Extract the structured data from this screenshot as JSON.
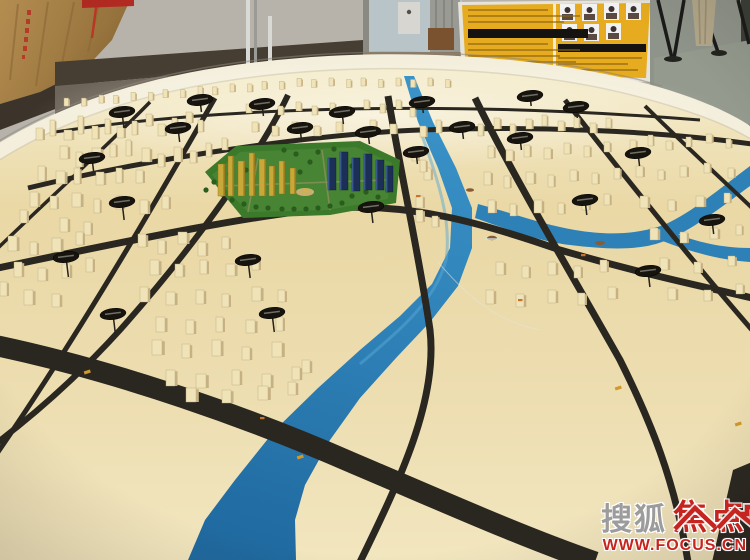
{
  "watermark": {
    "brand_gray": "搜狐",
    "brand_red": "焦点",
    "url": "WWW.FOCUS.CN"
  },
  "colors": {
    "wall": "#b7b3aa",
    "skirting": "#463e33",
    "wood": "#b3894c",
    "board_yellow": "#e6ab1e",
    "board_bar": "#151310",
    "rim": "#f4efdc",
    "road": "#2a2721",
    "river": "#2e81b7",
    "river_deep": "#1f699f",
    "building_face": "#f0e3b8",
    "building_side": "#c6b183",
    "dev_green": "#3c7a2b",
    "dev_green_dark": "#2a5c1d",
    "tower_gold": "#c8a838",
    "tower_navy": "#1c3057",
    "sign_black": "#17140e",
    "marker_gold": "#d19a28",
    "car_orange": "#c8742a",
    "boat_brown": "#8a5a32",
    "watermark_gray": "#9c9c9c",
    "watermark_red": "#c6241f",
    "floor_right": "#949a8e",
    "curtain": "#b3a78a",
    "metal": "#d9d9d6"
  }
}
